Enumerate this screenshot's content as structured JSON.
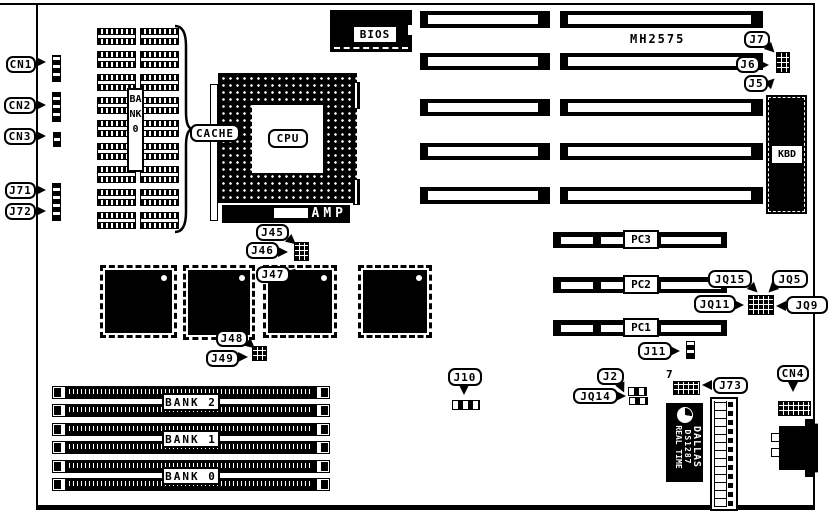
{
  "labels": {
    "cn1": "CN1",
    "cn2": "CN2",
    "cn3": "CN3",
    "j71": "J71",
    "j72": "J72",
    "cache": "CACHE",
    "cpu": "CPU",
    "amp": "AMP",
    "bios": "BIOS",
    "bank0_vertical": "BANK0",
    "mh2575": "MH2575",
    "j7": "J7",
    "j6": "J6",
    "j5": "J5",
    "kbd": "KBD",
    "j45": "J45",
    "j46": "J46",
    "j47": "J47",
    "j48": "J48",
    "j49": "J49",
    "pc3": "PC3",
    "pc2": "PC2",
    "pc1": "PC1",
    "jq15": "JQ15",
    "jq5": "JQ5",
    "jq11": "JQ11",
    "jq9": "JQ9",
    "j11": "J11",
    "j10": "J10",
    "j2": "J2",
    "jq14": "JQ14",
    "pin7": "7",
    "j73": "J73",
    "cn4": "CN4",
    "bank2": "BANK 2",
    "bank1": "BANK 1",
    "bank0": "BANK 0"
  },
  "rtc": {
    "line1": "DALLAS",
    "line2": "DS1287",
    "line3": "REAL TIME"
  },
  "colors": {
    "ink": "#000000",
    "background": "#ffffff"
  }
}
